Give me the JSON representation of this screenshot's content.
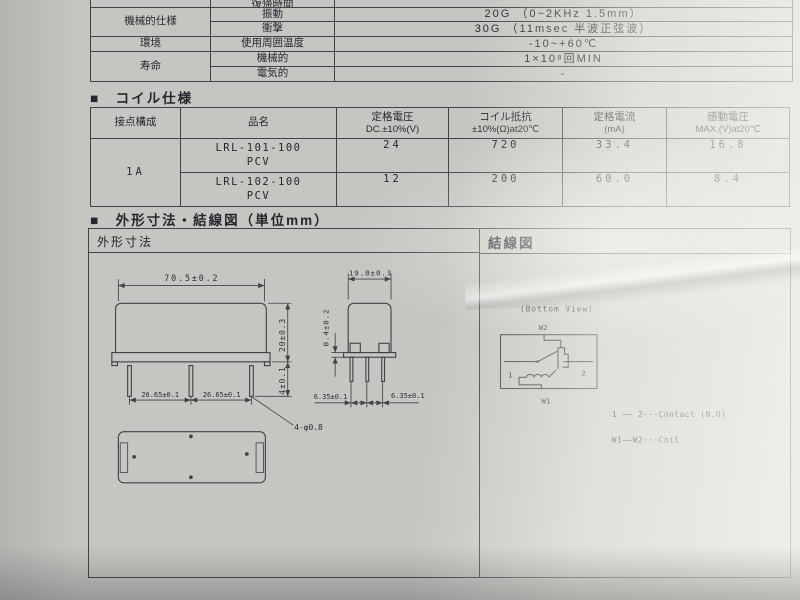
{
  "colors": {
    "paper": "#c6c5c1",
    "line": "#41414a",
    "text": "#26262e"
  },
  "spec_table": {
    "clipped_param": "復帰時間",
    "group_mech": "機械的仕様",
    "group_env": "環境",
    "group_life": "寿命",
    "rows": {
      "vibration": {
        "param": "振動",
        "value": "20G （0~2KHz 1.5mm）"
      },
      "shock": {
        "param": "衝撃",
        "value": "30G （11msec 半波正弦波）"
      },
      "temp": {
        "param": "使用周囲温度",
        "value": "-10~+60℃"
      },
      "life_mech": {
        "param": "機械的",
        "value": "1×10⁸回MIN"
      },
      "life_elec": {
        "param": "電気的",
        "value": "-"
      }
    }
  },
  "coil": {
    "title": "■　コイル仕様",
    "h": {
      "config": "接点構成",
      "name": "品名",
      "volt1": "定格電圧",
      "volt2": "DC.±10%(V)",
      "res1": "コイル抵抗",
      "res2": "±10%(Ω)at20℃",
      "cur1": "定格電流",
      "cur2": "(mA)",
      "opv1": "感動電圧",
      "opv2": "MAX.(V)at20℃"
    },
    "config_value": "1A",
    "rows": [
      {
        "name1": "LRL-101-100",
        "name2": "PCV",
        "volt": "24",
        "res": "720",
        "cur": "33.4",
        "opv": "16.8"
      },
      {
        "name1": "LRL-102-100",
        "name2": "PCV",
        "volt": "12",
        "res": "200",
        "cur": "60.0",
        "opv": "8.4"
      }
    ]
  },
  "outline": {
    "title": "■　外形寸法・結線図（単位mm）",
    "left_header": "外形寸法",
    "right_header": "結線図"
  },
  "dims": {
    "width": "70.5±0.2",
    "height": "20±0.3",
    "pin_len": "4±0.1",
    "pitch1": "26.65±0.1",
    "pitch2": "26.65±0.1",
    "pin_note": "4-φ0.8",
    "depth": "19.0±0.3",
    "standoff": "0.4±0.2",
    "pitch_l": "6.35±0.1",
    "pitch_r": "6.35±0.1"
  },
  "wiring": {
    "view_label": "(Bottom View)",
    "w1": "W1",
    "w2": "W2",
    "p1": "1",
    "p2": "2",
    "legend1": "1 ―― 2···Contact (N.O)",
    "legend2": "W1――W2···Coil"
  }
}
